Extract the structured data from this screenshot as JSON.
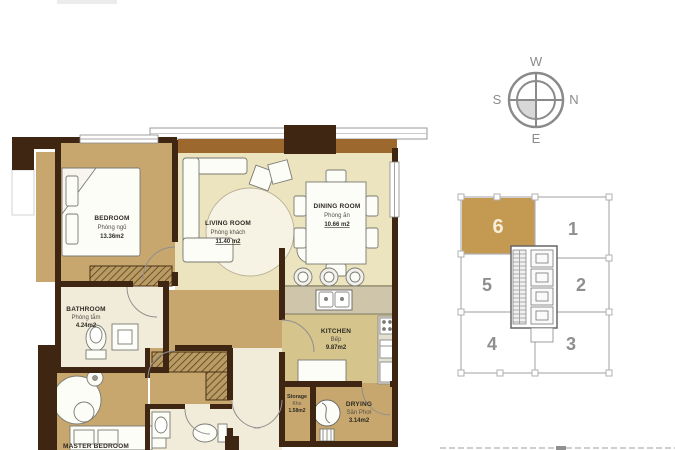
{
  "floorplan": {
    "rooms": {
      "bedroom": {
        "name": "BEDROOM",
        "subtitle": "Phòng ngủ",
        "area": "13.36m2"
      },
      "living": {
        "name": "LIVING ROOM",
        "subtitle": "Phòng khách",
        "area": "11.40 m2"
      },
      "dining": {
        "name": "DINING ROOM",
        "subtitle": "Phòng ăn",
        "area": "10.66 m2"
      },
      "bathroom": {
        "name": "BATHROOM",
        "subtitle": "Phòng tắm",
        "area": "4.24m2"
      },
      "kitchen": {
        "name": "KITCHEN",
        "subtitle": "Bếp",
        "area": "9.87m2"
      },
      "storage": {
        "name": "Storage",
        "subtitle": "Kho",
        "area": "1.58m2"
      },
      "drying": {
        "name": "DRYING",
        "subtitle": "Sân Phơi",
        "area": "3.14m2"
      },
      "master_bedroom": {
        "name": "MASTER BEDROOM"
      }
    }
  },
  "compass": {
    "top": "W",
    "left": "S",
    "right": "N",
    "bottom": "E"
  },
  "keyplan": {
    "highlighted_unit": "6",
    "units": [
      {
        "number": "6",
        "highlighted": true
      },
      {
        "number": "1",
        "highlighted": false
      },
      {
        "number": "5",
        "highlighted": false
      },
      {
        "number": "2",
        "highlighted": false
      },
      {
        "number": "4",
        "highlighted": false
      },
      {
        "number": "3",
        "highlighted": false
      }
    ]
  },
  "colors": {
    "wall": "#3f2613",
    "balcony_ledge": "#9c682e",
    "floor_tan": "#c7a76d",
    "floor_cream": "#ece3bf",
    "floor_kitchen": "#d5c48c",
    "floor_bath": "#f1ecd9",
    "keyplan_highlight": "#c49a52",
    "diagram_gray": "#8a8a8a"
  }
}
